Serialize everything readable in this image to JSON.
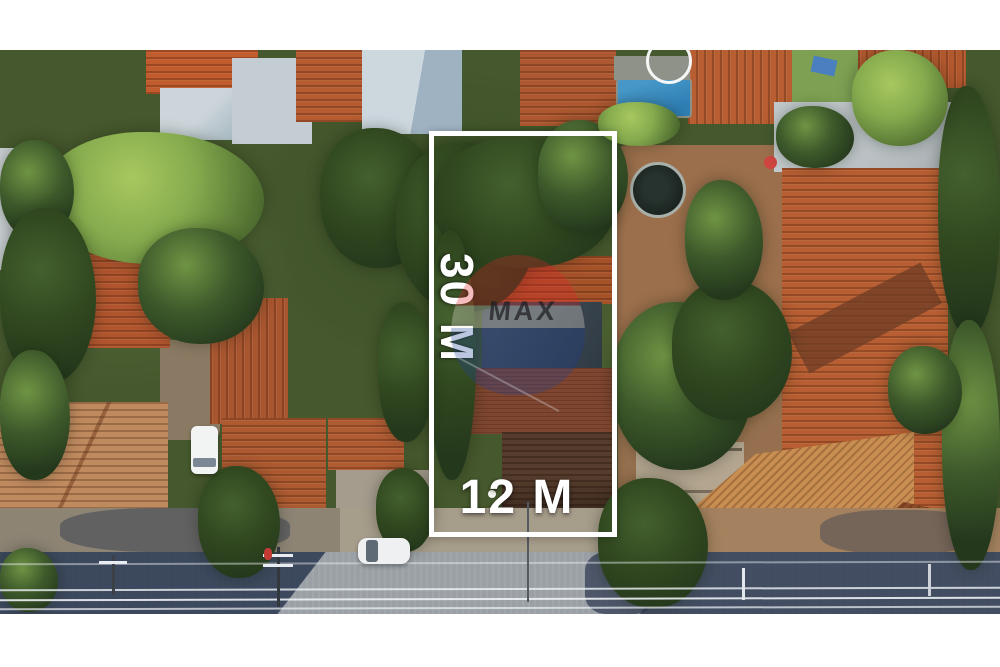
{
  "image_type": "aerial-drone-real-estate-photo",
  "lot": {
    "depth_label": "30 M",
    "width_label": "12 M",
    "outline_color": "#ffffff"
  },
  "watermark": {
    "brand_text": "MAX"
  },
  "palette": {
    "white": "#ffffff",
    "base": "#46582d",
    "tree_dark": "#24381c",
    "tree_mid": "#3e5a2b",
    "tree_light": "#6f9444",
    "tree_bright": "#85ab4e",
    "roof_orange": "#bf6434",
    "roof_deep": "#a5552c",
    "roof_brick": "#b75e32",
    "roof_faded": "#c08a5f",
    "roof_tan": "#c98e52",
    "roof_brown": "#7e4630",
    "roof_darkbrown": "#553c2c",
    "roof_slate": "#3e4953",
    "grey_roof": "#c3cdd3",
    "light_roof": "#cdd7de",
    "warehouse": "#b4bbbe",
    "dirt": "#9b6f4c",
    "dirt_light": "#a5825f",
    "lawn": "#7da053",
    "concrete": "#a59c8e",
    "verge": "#8d8474",
    "road": "#9aa0a5",
    "shadow": "#2c3850",
    "pool": "#2f7fb5",
    "wire": "#eef2f6",
    "balloon_red": "#dd2026",
    "balloon_blue": "#1c3f95",
    "balloon_band": "#f2ece2"
  }
}
